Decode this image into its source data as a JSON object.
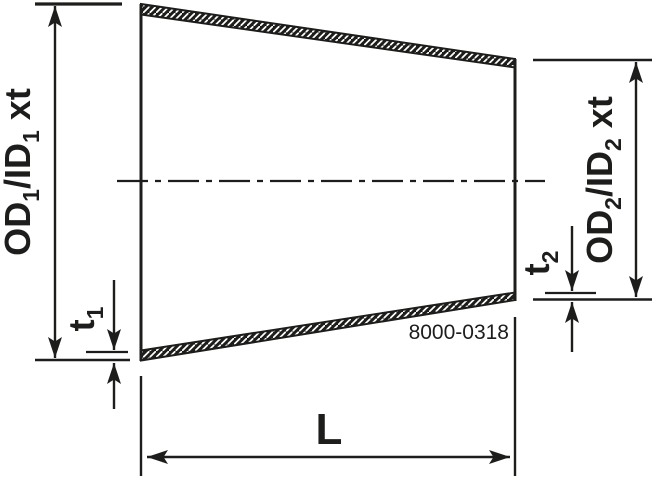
{
  "drawing": {
    "type": "concentric-reducer-section-drawing",
    "part_number": "8000-0318",
    "labels": {
      "od1": {
        "prefix": "OD",
        "sub1": "1",
        "mid": "/ID",
        "sub2": "1",
        "suffix": "xt"
      },
      "od2": {
        "prefix": "OD",
        "sub1": "2",
        "mid": "/ID",
        "sub2": "2",
        "suffix": "xt"
      },
      "t1": {
        "main": "t",
        "sub": "1"
      },
      "t2": {
        "main": "t",
        "sub": "2"
      },
      "length": "L"
    },
    "colors": {
      "ink": "#1d1d1b",
      "background": "#ffffff"
    }
  }
}
